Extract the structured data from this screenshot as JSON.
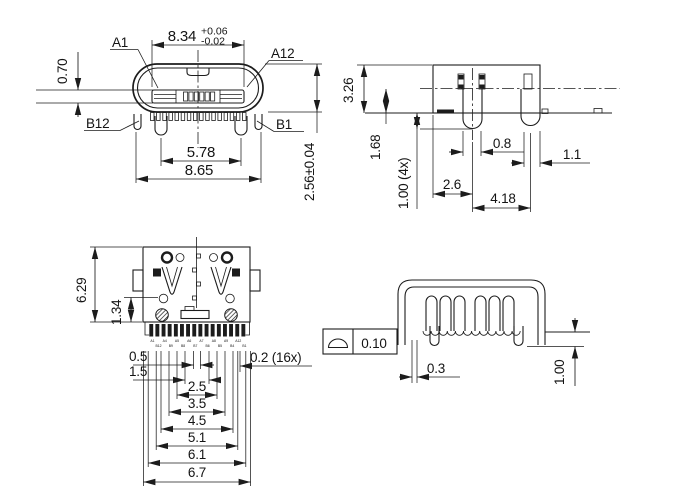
{
  "drawing": {
    "colors": {
      "line": "#1c1c1c",
      "background": "#ffffff"
    },
    "views": {
      "front": {
        "dim_width": "8.34",
        "tol_plus": "+0.06",
        "tol_minus": "-0.02",
        "label_a1": "A1",
        "label_a12": "A12",
        "label_b12": "B12",
        "label_b1": "B1",
        "tongue_thickness": "0.70",
        "leg_span": "5.78",
        "overall_width": "8.65",
        "height": "2.56±0.04"
      },
      "side": {
        "height": "3.26",
        "center_height": "1.68",
        "leg_length": "1.00 (4x)",
        "pin_width": "0.8",
        "leg_width": "1.1",
        "edge_to_pin": "2.6",
        "pin_to_leg": "4.18"
      },
      "bottom": {
        "depth": "6.29",
        "front_depth": "1.34",
        "pitch_a": "0.5",
        "pitch_b": "1.5",
        "pin_width": "0.2 (16x)",
        "span_25": "2.5",
        "span_35": "3.5",
        "span_45": "4.5",
        "span_51": "5.1",
        "span_61": "6.1",
        "span_67": "6.7",
        "pin_labels_top": [
          "A1",
          "A4",
          "A5",
          "A6",
          "A7",
          "A8",
          "A9",
          "A12"
        ],
        "pin_labels_bottom": [
          "B12",
          "B9",
          "B8",
          "B7",
          "B6",
          "B5",
          "B4",
          "B1"
        ]
      },
      "rear": {
        "gdt_symbol": "profile-of-a-surface",
        "profile_tolerance": "0.10",
        "gap": "0.3",
        "leg_protrusion": "1.00"
      }
    }
  }
}
